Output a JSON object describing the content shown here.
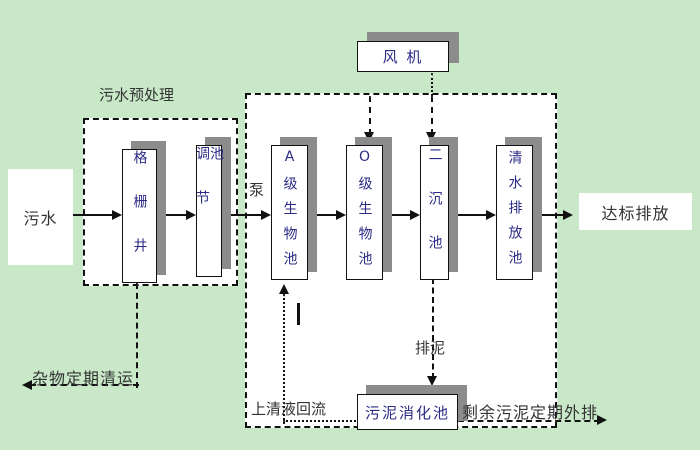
{
  "colors": {
    "background": "#c8e8c8",
    "box_fill": "#ffffff",
    "box_border": "#111111",
    "box_text": "#2b2b85",
    "label_text": "#333333",
    "shadow": "#8c8c8c"
  },
  "flow": {
    "source": "污水",
    "pretreatment_title": "污水预处理",
    "grid_well": "格栅井",
    "regulating_tank": "调节池",
    "pump": "泵",
    "a_bio_tank": "A级生物池",
    "o_bio_tank": "O级生物池",
    "secondary_tank": "二沉池",
    "clearwater_tank": "清水排放池",
    "blower": "风 机",
    "digestion_tank": "污泥消化池",
    "outfall": "达标排放"
  },
  "annotations": {
    "debris_removal": "杂物定期清运",
    "supernatant_return": "上清液回流",
    "sludge_discharge": "排泥",
    "excess_sludge": "剩余污泥定期外排"
  }
}
